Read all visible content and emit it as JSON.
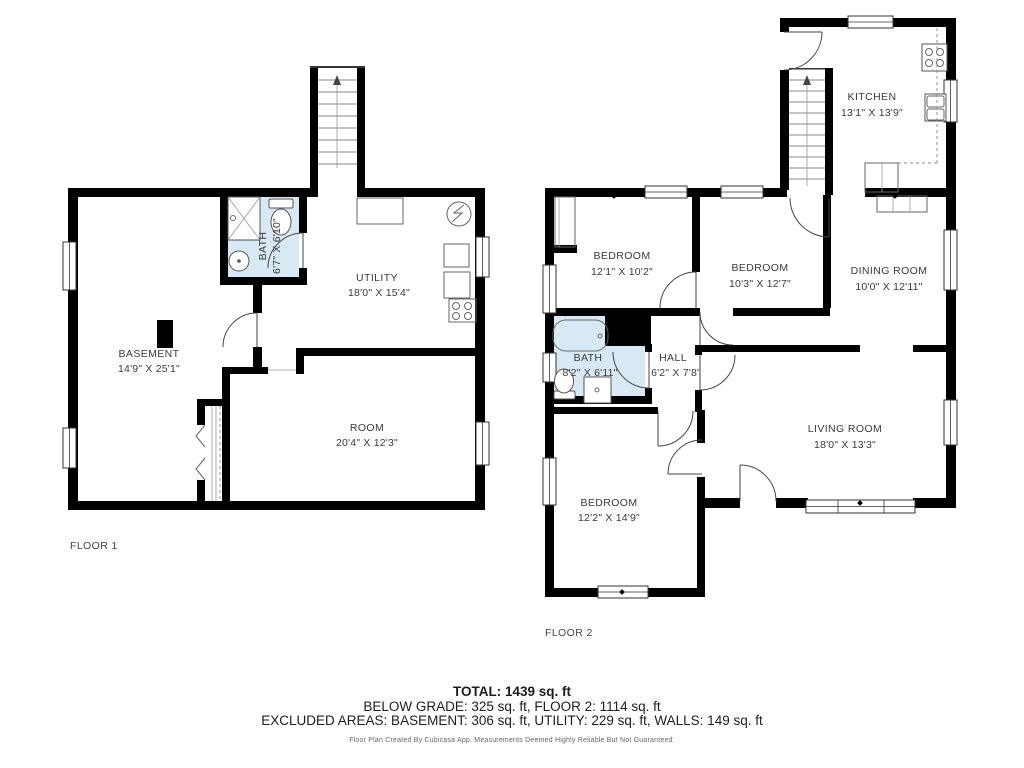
{
  "floor1": {
    "label": "FLOOR 1",
    "rooms": {
      "basement": {
        "name": "BASEMENT",
        "dims": "14'9\" X 25'1\""
      },
      "bath": {
        "name": "BATH",
        "dims": "6'7\" X 6'10\""
      },
      "utility": {
        "name": "UTILITY",
        "dims": "18'0\" X 15'4\""
      },
      "room": {
        "name": "ROOM",
        "dims": "20'4\" X 12'3\""
      }
    }
  },
  "floor2": {
    "label": "FLOOR 2",
    "rooms": {
      "kitchen": {
        "name": "KITCHEN",
        "dims": "13'1\" X 13'9\""
      },
      "bedroom1": {
        "name": "BEDROOM",
        "dims": "12'1\" X 10'2\""
      },
      "bedroom2": {
        "name": "BEDROOM",
        "dims": "10'3\" X 12'7\""
      },
      "dining": {
        "name": "DINING ROOM",
        "dims": "10'0\" X 12'11\""
      },
      "bath": {
        "name": "BATH",
        "dims": "8'2\" X 6'11\""
      },
      "hall": {
        "name": "HALL",
        "dims": "6'2\" X 7'8\""
      },
      "living": {
        "name": "LIVING ROOM",
        "dims": "18'0\" X 13'3\""
      },
      "bedroom3": {
        "name": "BEDROOM",
        "dims": "12'2\" X 14'9\""
      }
    }
  },
  "summary": {
    "total": "TOTAL: 1439 sq. ft",
    "below_grade_line": "BELOW GRADE: 325 sq. ft, FLOOR 2: 1114 sq. ft",
    "excluded_line": "EXCLUDED AREAS: BASEMENT: 306 sq. ft, UTILITY: 229 sq. ft, WALLS: 149 sq. ft",
    "credit": "Floor Plan Created By Cubicasa App. Measurements Deemed Highly Reliable But Not Guaranteed."
  },
  "colors": {
    "wall": "#000000",
    "bath_fill": "#d8e9f6",
    "label_text": "#3a3a3a"
  }
}
